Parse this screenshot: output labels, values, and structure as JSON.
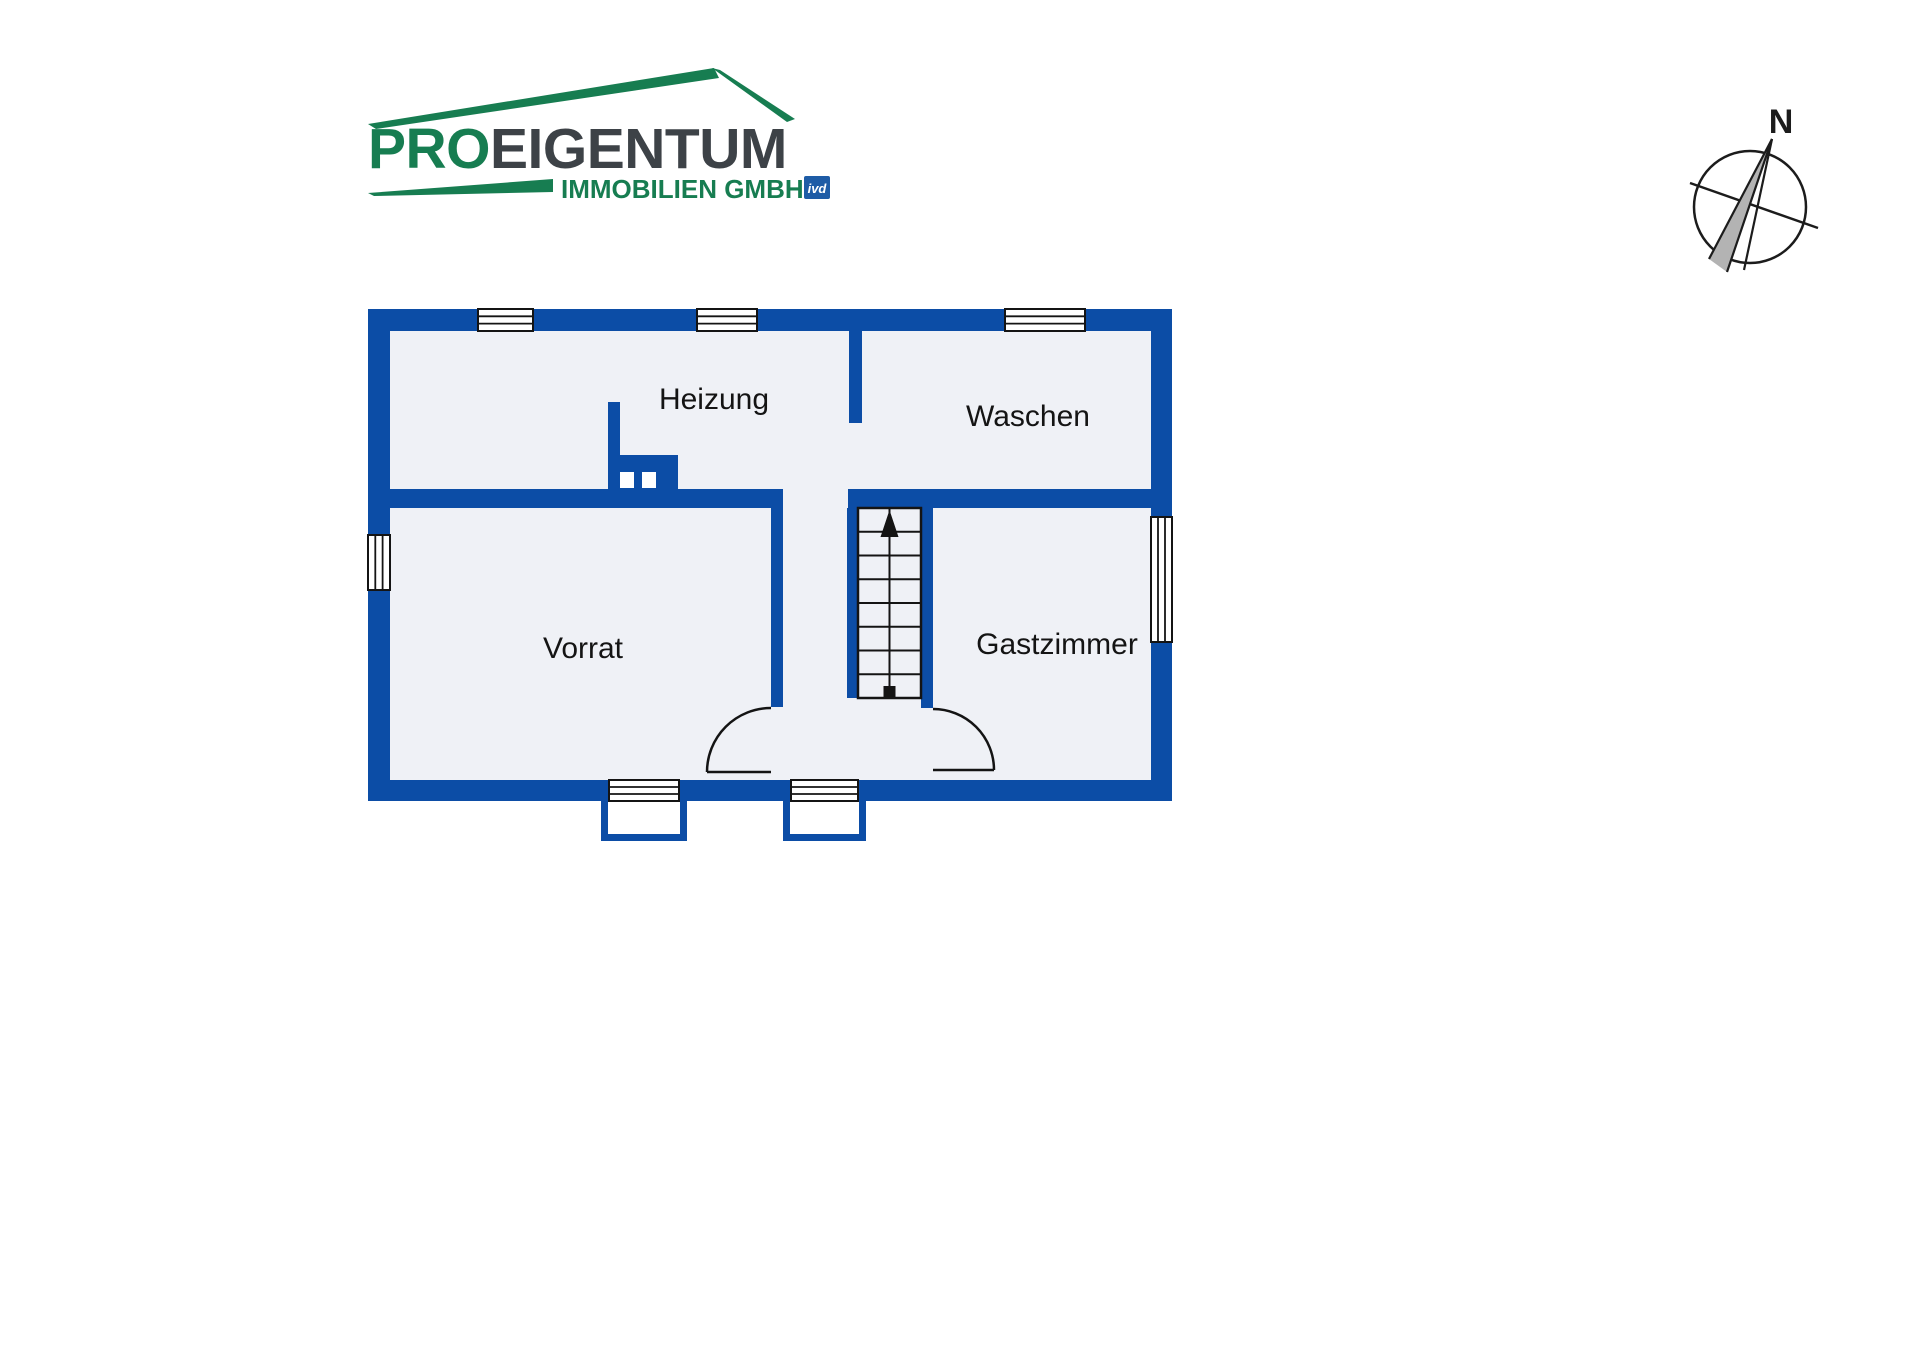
{
  "logo": {
    "brand_primary": "PRO",
    "brand_secondary": "EIGENTUM",
    "subtitle": "IMMOBILIEN GMBH",
    "badge_label": "ivd",
    "colors": {
      "green": "#177d51",
      "dark_gray": "#3d4247",
      "badge_blue": "#1e5ca6"
    }
  },
  "compass": {
    "north_label": "N",
    "needle_gray": "#b3b3b3",
    "line_color": "#1c1c1c"
  },
  "floor_plan": {
    "colors": {
      "wall": "#0c4da6",
      "room_fill": "#eff1f6",
      "line": "#141414",
      "label_text": "#141414"
    },
    "rooms": [
      {
        "id": "heizung",
        "label": "Heizung"
      },
      {
        "id": "waschen",
        "label": "Waschen"
      },
      {
        "id": "vorrat",
        "label": "Vorrat"
      },
      {
        "id": "gastzimmer",
        "label": "Gastzimmer"
      }
    ],
    "features": {
      "stairs_direction": "up",
      "door_count": 2,
      "window_count": 7,
      "chimney": true
    }
  }
}
